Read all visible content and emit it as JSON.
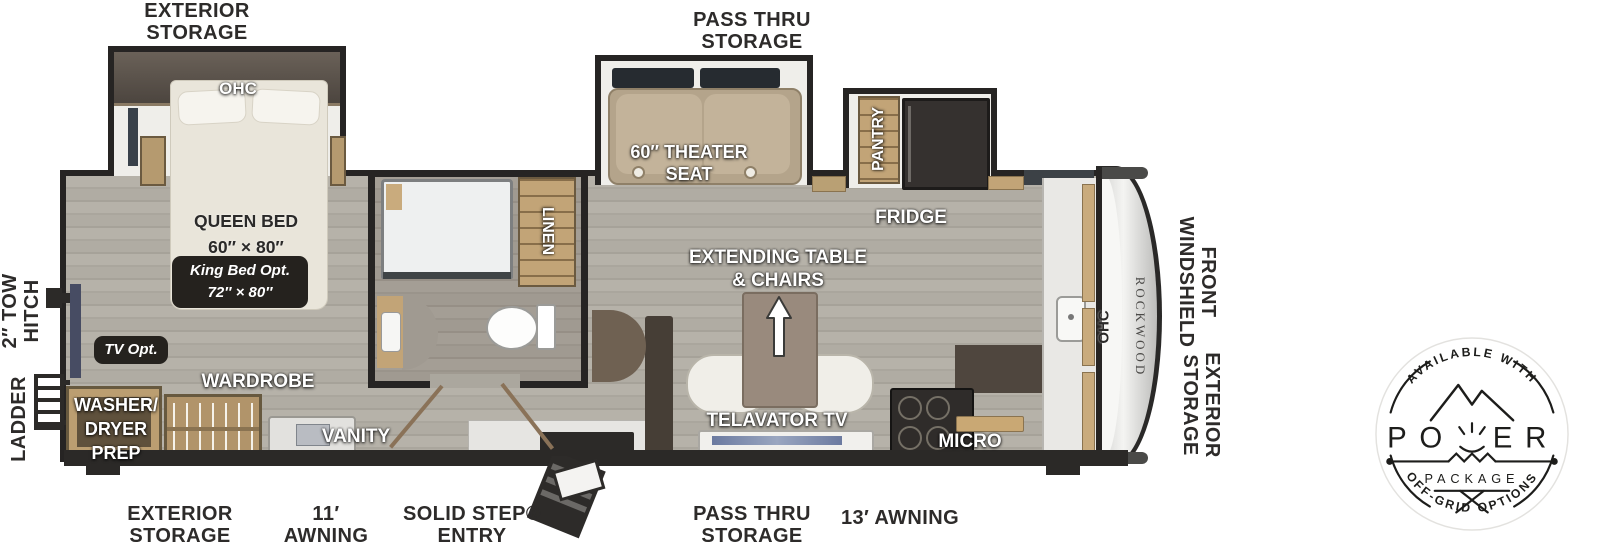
{
  "colors": {
    "wall": "#262423",
    "floor_wood": "#b0aca3",
    "cabinet_wood": "#c2a477",
    "label_ink": "#2d2b2a",
    "appliance_dark": "#2f2c2a",
    "seat_tan": "#b4a48b",
    "bed_cream": "#e9e5da",
    "badge_ink": "#1d1d1b",
    "option_badge_bg": "#25221e"
  },
  "exterior_labels": {
    "storage_top": {
      "l1": "EXTERIOR",
      "l2": "STORAGE"
    },
    "passthru_top": {
      "l1": "PASS THRU",
      "l2": "STORAGE"
    },
    "storage_bottom": {
      "l1": "EXTERIOR",
      "l2": "STORAGE"
    },
    "awning_11": {
      "l1": "11′",
      "l2": "AWNING"
    },
    "solid_step": {
      "l1": "SOLID STEP®",
      "l2": "ENTRY"
    },
    "passthru_bottom": {
      "l1": "PASS THRU",
      "l2": "STORAGE"
    },
    "awning_13": "13′ AWNING",
    "tow_hitch": {
      "l1": "2″ TOW",
      "l2": "HITCH"
    },
    "ladder": "LADDER",
    "front_windshield": {
      "l1": "FRONT",
      "l2": "WINDSHIELD"
    },
    "storage_front": {
      "l1": "EXTERIOR",
      "l2": "STORAGE"
    }
  },
  "rooms": {
    "bedroom": {
      "ohc": "OHC",
      "bed_l1": "QUEEN BED",
      "bed_l2": "60″ × 80″",
      "king_opt_l1": "King Bed Opt.",
      "king_opt_l2": "72″ × 80″",
      "tv_opt": "TV Opt.",
      "wardrobe": "WARDROBE",
      "washer_l1": "WASHER/",
      "washer_l2": "DRYER",
      "washer_l3": "PREP"
    },
    "bath": {
      "linen": "LINEN",
      "vanity": "VANITY"
    },
    "living": {
      "theater_l1": "60″ THEATER",
      "theater_l2": "SEAT",
      "table_l1": "EXTENDING TABLE",
      "table_l2": "& CHAIRS",
      "telavator": "TELAVATOR TV"
    },
    "kitchen": {
      "pantry": "PANTRY",
      "fridge": "FRIDGE",
      "micro": "MICRO",
      "ohc": "OHC"
    },
    "front": {
      "brand": "ROCKWOOD"
    }
  },
  "badge": {
    "arc_top": "AVAILABLE WITH",
    "title": "POWER",
    "title_left": "PO",
    "title_right": "ER",
    "subtitle": "PACKAGE",
    "arc_bottom": "OFF-GRID OPTIONS"
  }
}
